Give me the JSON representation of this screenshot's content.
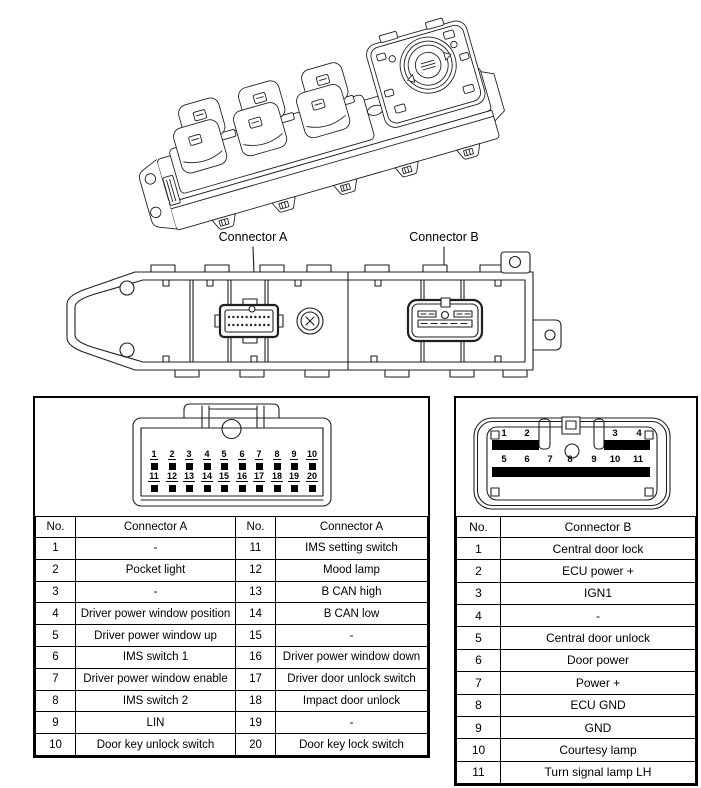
{
  "figure": {
    "connector_a_label": "Connector A",
    "connector_b_label": "Connector B"
  },
  "diagram_a": {
    "top_pins": [
      "1",
      "2",
      "3",
      "4",
      "5",
      "6",
      "7",
      "8",
      "9",
      "10"
    ],
    "bottom_pins": [
      "11",
      "12",
      "13",
      "14",
      "15",
      "16",
      "17",
      "18",
      "19",
      "20"
    ]
  },
  "diagram_b": {
    "top_pins": [
      "1",
      "2",
      "3",
      "4"
    ],
    "bottom_pins": [
      "5",
      "6",
      "7",
      "8",
      "9",
      "10",
      "11"
    ]
  },
  "tables": {
    "a": {
      "headers": [
        "No.",
        "Connector A",
        "No.",
        "Connector A"
      ],
      "rows": [
        {
          "c0": "1",
          "c1": "-",
          "c2": "11",
          "c3": "IMS setting switch"
        },
        {
          "c0": "2",
          "c1": "Pocket light",
          "c2": "12",
          "c3": "Mood lamp"
        },
        {
          "c0": "3",
          "c1": "-",
          "c2": "13",
          "c3": "B CAN high"
        },
        {
          "c0": "4",
          "c1": "Driver power window position",
          "c2": "14",
          "c3": "B CAN low"
        },
        {
          "c0": "5",
          "c1": "Driver power window up",
          "c2": "15",
          "c3": "-"
        },
        {
          "c0": "6",
          "c1": "IMS switch 1",
          "c2": "16",
          "c3": "Driver power window down"
        },
        {
          "c0": "7",
          "c1": "Driver power window enable",
          "c2": "17",
          "c3": "Driver door unlock switch"
        },
        {
          "c0": "8",
          "c1": "IMS switch 2",
          "c2": "18",
          "c3": "Impact door unlock"
        },
        {
          "c0": "9",
          "c1": "LIN",
          "c2": "19",
          "c3": "-"
        },
        {
          "c0": "10",
          "c1": "Door key unlock switch",
          "c2": "20",
          "c3": "Door key lock switch"
        }
      ]
    },
    "b": {
      "headers": [
        "No.",
        "Connector B"
      ],
      "rows": [
        {
          "no": "1",
          "desc": "Central door lock"
        },
        {
          "no": "2",
          "desc": "ECU power +"
        },
        {
          "no": "3",
          "desc": "IGN1"
        },
        {
          "no": "4",
          "desc": "-"
        },
        {
          "no": "5",
          "desc": "Central door unlock"
        },
        {
          "no": "6",
          "desc": "Door power"
        },
        {
          "no": "7",
          "desc": "Power +"
        },
        {
          "no": "8",
          "desc": "ECU GND"
        },
        {
          "no": "9",
          "desc": "GND"
        },
        {
          "no": "10",
          "desc": "Courtesy lamp"
        },
        {
          "no": "11",
          "desc": "Turn signal lamp LH"
        }
      ]
    }
  }
}
